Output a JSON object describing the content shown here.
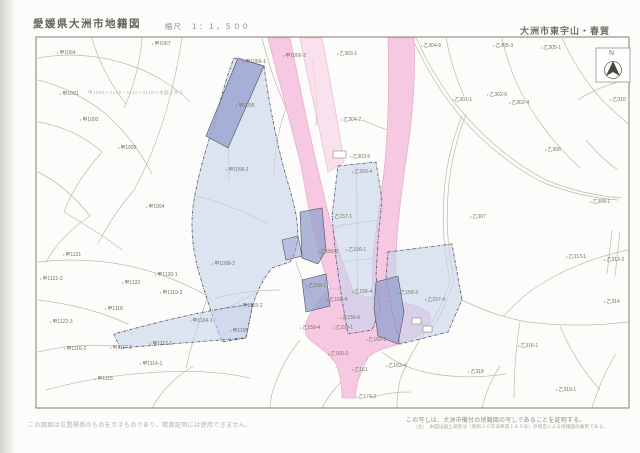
{
  "page": {
    "title_left": "愛媛県大洲市地籍図",
    "scale_label": "縮尺　１：１，５００",
    "title_right": "大洲市東宇山・春賀",
    "north_label": "N",
    "map_note": "甲1066〜1106・1111〜1118ハ本図ニ存ス",
    "footer_left": "この図面は位置関係のものを示すものであり、精度証明には使用できません。",
    "footer_right_line1": "この写しは、大洲市備付の地籍図の写しであることを証明する。",
    "footer_right_line2": "（注）　本図は国土調査法（昭和２６年法律第１８０号）の規定による地籍図の複製である。"
  },
  "colors": {
    "pink": "#f6c8e1",
    "pink_light": "#f9d8ea",
    "blue_light": "#c7d3ec",
    "blue_dark": "#99a3d0",
    "line": "#c3b8aa",
    "frame": "#8d887e"
  },
  "map": {
    "parcel_labels": [
      [
        243,
        59,
        "甲1066-1"
      ],
      [
        283,
        53,
        "甲1066-2"
      ],
      [
        152,
        41,
        "甲1067"
      ],
      [
        57,
        50,
        "甲1064"
      ],
      [
        60,
        91,
        "甲1091"
      ],
      [
        80,
        117,
        "甲1092"
      ],
      [
        118,
        145,
        "甲1093"
      ],
      [
        146,
        204,
        "甲1094"
      ],
      [
        236,
        103,
        "甲1095"
      ],
      [
        226,
        167,
        "甲1096-1"
      ],
      [
        212,
        261,
        "甲1098-2"
      ],
      [
        240,
        303,
        "甲1103-2"
      ],
      [
        63,
        252,
        "甲1121"
      ],
      [
        40,
        276,
        "甲1121-2"
      ],
      [
        122,
        280,
        "甲1122"
      ],
      [
        155,
        272,
        "甲1120-1"
      ],
      [
        160,
        290,
        "甲1119-3"
      ],
      [
        105,
        306,
        "甲1118"
      ],
      [
        50,
        319,
        "甲1122-3"
      ],
      [
        64,
        346,
        "甲1116-2"
      ],
      [
        110,
        345,
        "甲1117-2"
      ],
      [
        150,
        341,
        "甲1117-1"
      ],
      [
        95,
        376,
        "甲1115"
      ],
      [
        140,
        361,
        "甲1114-1"
      ],
      [
        190,
        318,
        "甲1104-1"
      ],
      [
        230,
        328,
        "甲1105"
      ],
      [
        337,
        51,
        "乙303-1"
      ],
      [
        421,
        43,
        "乙304-6"
      ],
      [
        493,
        43,
        "乙305-3"
      ],
      [
        541,
        45,
        "乙305-1"
      ],
      [
        341,
        117,
        "乙304-2"
      ],
      [
        350,
        154,
        "乙303-5"
      ],
      [
        352,
        169,
        "乙303-4"
      ],
      [
        332,
        214,
        "乙157-1"
      ],
      [
        346,
        247,
        "乙156-1"
      ],
      [
        318,
        249,
        "乙156-2"
      ],
      [
        306,
        283,
        "乙158-1"
      ],
      [
        327,
        297,
        "乙158-4"
      ],
      [
        352,
        289,
        "乙156-4"
      ],
      [
        340,
        315,
        "乙156-6"
      ],
      [
        300,
        325,
        "乙159-4"
      ],
      [
        333,
        325,
        "乙159-1"
      ],
      [
        366,
        337,
        "乙160-1"
      ],
      [
        328,
        351,
        "乙160-3"
      ],
      [
        352,
        367,
        "乙161"
      ],
      [
        356,
        394,
        "乙174-2"
      ],
      [
        386,
        363,
        "乙163-4"
      ],
      [
        398,
        290,
        "乙158-3"
      ],
      [
        425,
        297,
        "乙157-4"
      ],
      [
        452,
        97,
        "乙301-1"
      ],
      [
        487,
        92,
        "乙302-6"
      ],
      [
        509,
        100,
        "乙302-4"
      ],
      [
        545,
        147,
        "乙306"
      ],
      [
        470,
        214,
        "乙307"
      ],
      [
        590,
        199,
        "乙308-1"
      ],
      [
        566,
        254,
        "乙313-1"
      ],
      [
        604,
        257,
        "乙313-2"
      ],
      [
        604,
        299,
        "乙314"
      ],
      [
        518,
        343,
        "乙316-1"
      ],
      [
        468,
        369,
        "乙318"
      ],
      [
        556,
        387,
        "乙319-1"
      ],
      [
        610,
        97,
        "乙310"
      ]
    ]
  }
}
